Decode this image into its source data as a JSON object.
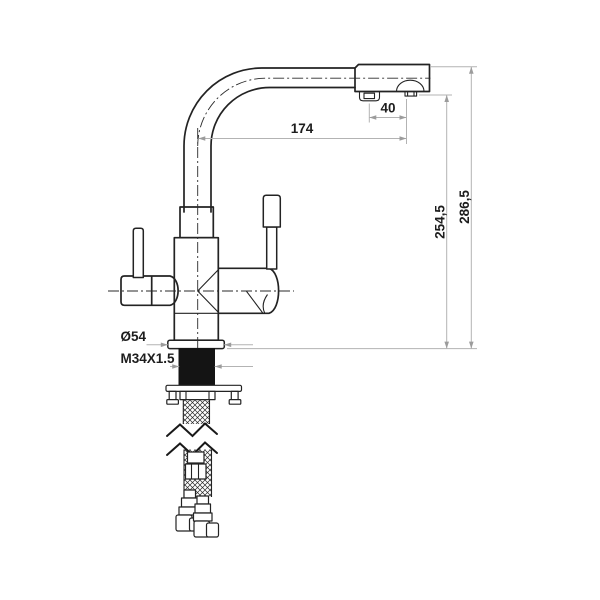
{
  "drawing": {
    "background_color": "#ffffff",
    "line_color": "#232323",
    "dimension_line_color": "#b3b3b3",
    "dimension_text_color": "#1d1d1d",
    "labels": {
      "outlet_spacing": "40",
      "spout_reach": "174",
      "height_to_outlet": "254,5",
      "overall_height": "286,5",
      "base_diameter": "Ø54",
      "mounting_thread": "M34X1.5"
    }
  }
}
